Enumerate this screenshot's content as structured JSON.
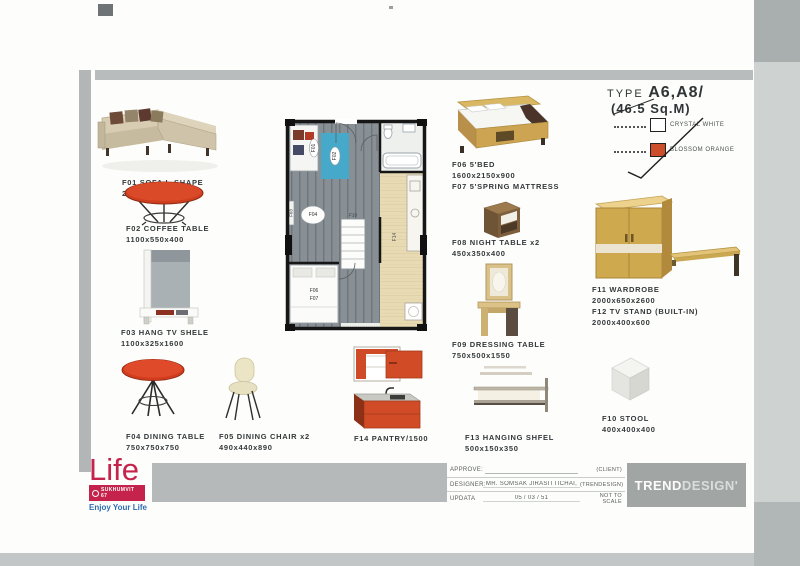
{
  "header": {
    "type_label": "TYPE",
    "type_value": "A6,A8/",
    "area_value": "(46.5 Sq.M)"
  },
  "legend": {
    "crystal": {
      "label": "CRYSTAL WHITE"
    },
    "blossom": {
      "label": "BLOSSOM ORANGE"
    }
  },
  "colors": {
    "crystal_white": "#ffffff",
    "blossom_orange": "#cc4e2b",
    "table_red": "#d23c1e",
    "pantry_orange": "#d04b26",
    "rug_blue": "#47a9ca",
    "brand_magenta": "#c5234c",
    "tagline_blue": "#2d6cb3",
    "studio_gray": "#a1a6a5"
  },
  "items": {
    "f01": {
      "label": "F01 SOFA L-SHAPE",
      "dims": "2200x1470X910"
    },
    "f02": {
      "label": "F02 COFFEE TABLE",
      "dims": "1100x550x400"
    },
    "f03": {
      "label": "F03 HANG TV SHELE",
      "dims": "1100x325x1600"
    },
    "f04": {
      "label": "F04 DINING TABLE",
      "dims": "750x750x750"
    },
    "f05": {
      "label": "F05 DINING CHAIR x2",
      "dims": "490x440x890"
    },
    "f06": {
      "label": "F06 5'BED",
      "dims": "1600x2150x900",
      "extra": "F07 5'SPRING MATTRESS"
    },
    "f08": {
      "label": "F08 NIGHT TABLE x2",
      "dims": "450x350x400"
    },
    "f09": {
      "label": "F09 DRESSING TABLE",
      "dims": "750x500x1550"
    },
    "f10": {
      "label": "F10 STOOL",
      "dims": "400x400x400"
    },
    "f11": {
      "label": "F11 WARDROBE",
      "dims": "2000x650x2600"
    },
    "f12": {
      "label": "F12 TV STAND (BUILT-IN)",
      "dims": "2000x400x600"
    },
    "f13": {
      "label": "F13 HANGING SHFEL",
      "dims": "500x150x350"
    },
    "f14": {
      "label": "F14 PANTRY/1500"
    }
  },
  "plan": {
    "labels": {
      "f01": "F01",
      "f02": "F02",
      "f03": "F03",
      "f04": "F04",
      "f06": "F06",
      "f07": "F07",
      "f13": "F13",
      "f14": "F14"
    }
  },
  "footer": {
    "brand": {
      "name": "Life",
      "sub": "SUKHUMVIT 67",
      "tagline": "Enjoy Your Life"
    },
    "titleblock": {
      "approve_label": "APPROVE:",
      "approve_note": "(CLIENT)",
      "designer_label": "DESIGNER:",
      "designer_value": "MR. SOMSAK  JIRASITTICHAI,",
      "designer_note": "(TRENDESIGN)",
      "update_label": "UPDATA",
      "update_value": "05  /  03  /  51",
      "update_note": "NOT TO SCALE"
    },
    "studio": {
      "part1": "TREND",
      "part2": "DESIGN'"
    }
  }
}
